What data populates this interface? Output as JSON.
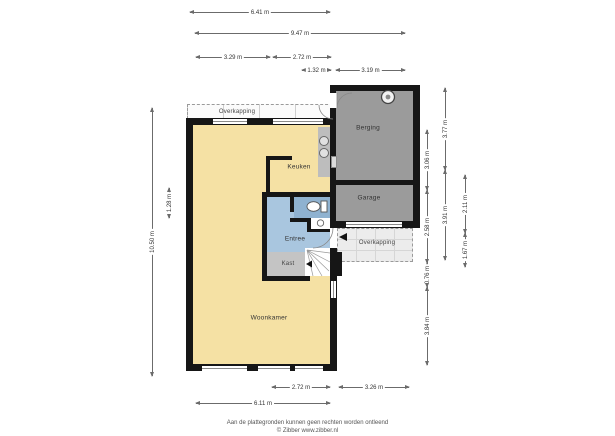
{
  "plan": {
    "rooms": {
      "woonkamer": "Woonkamer",
      "keuken": "Keuken",
      "entree": "Entree",
      "kast": "Kast",
      "berging": "Berging",
      "garage": "Garage",
      "overkapping_top": "Overkapping",
      "overkapping_right": "Overkapping"
    },
    "icons": {
      "entrance_arrow": "black triangle pointing to front door",
      "vent_circle": "round vent/boiler symbol in berging",
      "toilet": "toilet bowl with cistern in wc",
      "sink": "small washbasin beside wc",
      "hob_circles": "two round basin/hob circles on kitchen counter",
      "stairs": "winder staircase with down arrow",
      "door_arcs": "door swing arcs at entree and berging"
    },
    "colors": {
      "floor_living": "#F5E1A4",
      "floor_storage": "#9B9B9B",
      "floor_entry": "#A9C6DF",
      "floor_wc": "#8FB2D0",
      "floor_closet": "#C4C4C4",
      "counter": "#BDBDBD",
      "wall": "#161616",
      "canopy": "#ECECEC"
    }
  },
  "dimensions": {
    "top": {
      "d641": "6.41 m",
      "d947": "9.47 m",
      "d329": "3.29 m",
      "d272": "2.72 m",
      "d132": "1.32 m",
      "d319": "3.19 m"
    },
    "bottom": {
      "d272": "2.72 m",
      "d326": "3.26 m",
      "d611": "6.11 m"
    },
    "left": {
      "d1050": "10.50 m",
      "d128": "1.28 m"
    },
    "right": {
      "d306": "3.06 m",
      "d258": "2.58 m",
      "d076": "0.76 m",
      "d384": "3.84 m",
      "d377": "3.77 m",
      "d391": "3.91 m",
      "d211": "2.11 m",
      "d167": "1.67 m"
    }
  },
  "footer": {
    "disclaimer": "Aan de plattegronden kunnen geen rechten worden ontleend",
    "copyright": "© Zibber www.zibber.nl"
  }
}
